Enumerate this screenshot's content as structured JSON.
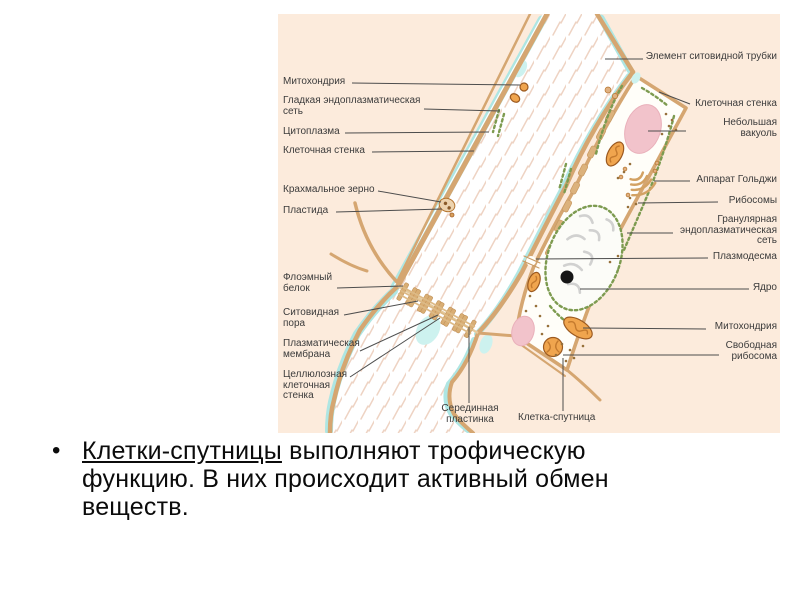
{
  "slide": {
    "bullet": {
      "marker": "•",
      "lead_underlined": "Клетки-спутницы",
      "line1_rest": " выполняют трофическую",
      "line2": "функцию. В них происходит активный обмен",
      "line3": "веществ."
    }
  },
  "diagram": {
    "labels": {
      "mitochondrion_left": "Митохондрия",
      "smooth_er": "Гладкая эндоплазматическая\nсеть",
      "cytoplasm": "Цитоплазма",
      "cell_wall_left": "Клеточная стенка",
      "starch_grain": "Крахмальное зерно",
      "plastid": "Пластида",
      "phloem_protein": "Флоэмный\nбелок",
      "sieve_pore": "Ситовидная\nпора",
      "plasma_membrane": "Плазматическая\nмембрана",
      "cellulose_cell_wall": "Целлюлозная\nклеточная\nстенка",
      "middle_lamella": "Серединная\nпластинка",
      "companion_cell": "Клетка-спутница",
      "sieve_tube_element": "Элемент ситовидной трубки",
      "cell_wall_right": "Клеточная стенка",
      "small_vacuole": "Небольшая\nвакуоль",
      "golgi_apparatus": "Аппарат Гольджи",
      "ribosomes": "Рибосомы",
      "granular_er": "Гранулярная\nэндоплазматическая\nсеть",
      "plasmodesma": "Плазмодесма",
      "nucleus": "Ядро",
      "mitochondrion_right": "Митохондрия",
      "free_ribosome": "Свободная\nрибосома"
    },
    "colors": {
      "panel_bg": "#fcebdc",
      "cell_wall": "#d5a671",
      "cytoplasm_cyan": "#aee6e3",
      "vacuole_pink": "#f2c3cb",
      "mitochondrion_orange": "#f0a54e",
      "er_green": "#7d9b50",
      "label_text": "#3b3b3b",
      "leader_line": "#4d4d4d"
    }
  }
}
